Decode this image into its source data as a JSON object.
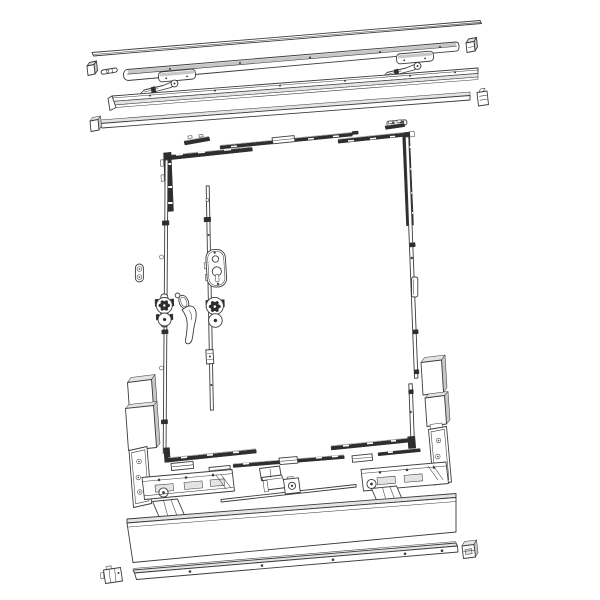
{
  "figure": {
    "kind": "Exploded hardware diagram - lift and slide door fitting set",
    "background": "#ffffff"
  },
  "theme": {
    "ink": "#2e2e2e",
    "line": "#3c3c3c",
    "highlight": "#a8a8a8",
    "paper": "#ffffff",
    "shade-light": "#e4e4e4",
    "shade-mid": "#c7c7c7"
  },
  "components": {
    "top-cover-profile": "Top cover profile",
    "upper-end-cap": "Upper end cap",
    "connector-pin": "Connector pin",
    "upper-guide-track": "Upper guide track",
    "guide-track-end-cap": "Guide track end cap",
    "glide-shoe-left": "Glide shoe (left)",
    "glide-shoe-right": "Glide shoe (right)",
    "tilt-arm-left": "Tilt control arm (left)",
    "tilt-arm-right": "Tilt control arm (right)",
    "upper-running-rail": "Upper running rail",
    "upper-cover-rail": "Upper cover rail",
    "cover-rail-end-cap": "Cover rail end cap",
    "cover-rail-clip": "Cover rail clip",
    "flat-clip": "Flat clip",
    "espag-corner-top-left": "Corner drive, top left",
    "espag-clip-top-left": "Locking clip, top left",
    "espag-bar-top": "Top espagnolette bar",
    "espag-corner-top-right": "Corner drive, top right",
    "espag-clip-top-right": "Locking clip, top right",
    "left-espag-bar": "Left espagnolette bar",
    "fixing-plate": "Oval fixing plate",
    "corner-gear-left": "Drive gear, left bar",
    "lock-drive-bar": "Central lock drive bar",
    "lock-case": "Mortise lock case",
    "lock-gear": "Lock drive gear",
    "striker-fitting": "Striker fitting",
    "door-handle": "Door handle",
    "right-espag-bar": "Right espagnolette bar",
    "espag-corner-bottom-left": "Corner drive, bottom left",
    "espag-bar-bottom": "Bottom espagnolette bar",
    "espag-corner-bottom-right": "Corner drive, bottom right",
    "slider-block-left": "Slider block (left)",
    "slider-block-mid": "Slider block (middle)",
    "slider-block-right": "Slider block (right)",
    "glazing-block-left": "Spacer blocks (left)",
    "glazing-block-right": "Spacer blocks (right)",
    "roller-bogie-left": "Roller bogie (left)",
    "roller-bogie-right": "Roller bogie (right)",
    "guide-bracket": "Guide bracket",
    "connecting-rod": "Connecting rod",
    "rod-coupling": "Rod coupling",
    "threshold-profile": "Threshold profile",
    "bottom-running-track": "Bottom running track",
    "track-end-cap": "Track end cap (right)",
    "track-end-bracket": "Track end bracket (left)"
  }
}
